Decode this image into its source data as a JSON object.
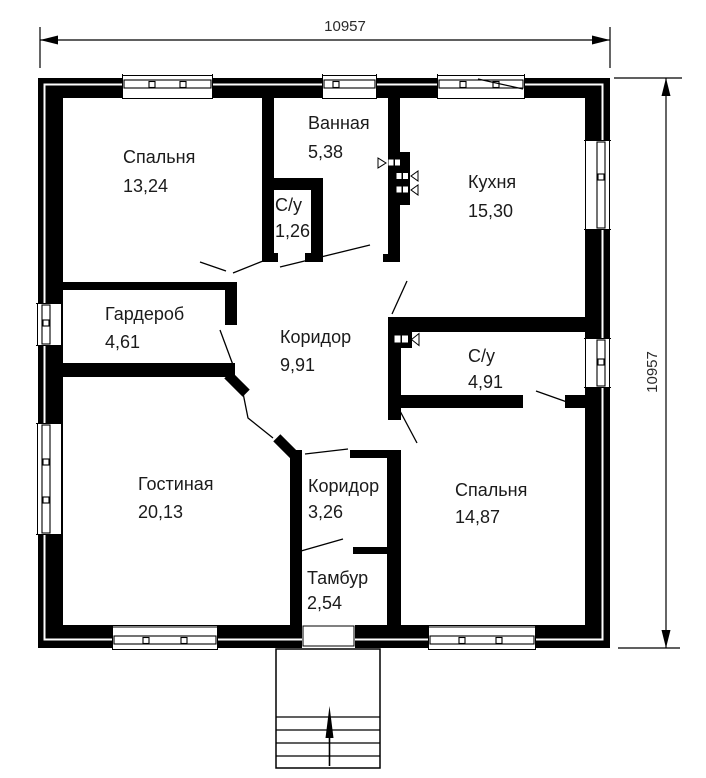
{
  "plan": {
    "title": "floor-plan",
    "dimensions": {
      "top": "10957",
      "right": "10957"
    },
    "rooms": [
      {
        "name": "Спальня",
        "area": "13,24"
      },
      {
        "name": "Ванная",
        "area": "5,38"
      },
      {
        "name": "С/у",
        "area": "1,26"
      },
      {
        "name": "Кухня",
        "area": "15,30"
      },
      {
        "name": "Гардероб",
        "area": "4,61"
      },
      {
        "name": "Коридор",
        "area": "9,91"
      },
      {
        "name": "С/у",
        "area": "4,91"
      },
      {
        "name": "Гостиная",
        "area": "20,13"
      },
      {
        "name": "Коридор",
        "area": "3,26"
      },
      {
        "name": "Спальня",
        "area": "14,87"
      },
      {
        "name": "Тамбур",
        "area": "2,54"
      }
    ]
  }
}
